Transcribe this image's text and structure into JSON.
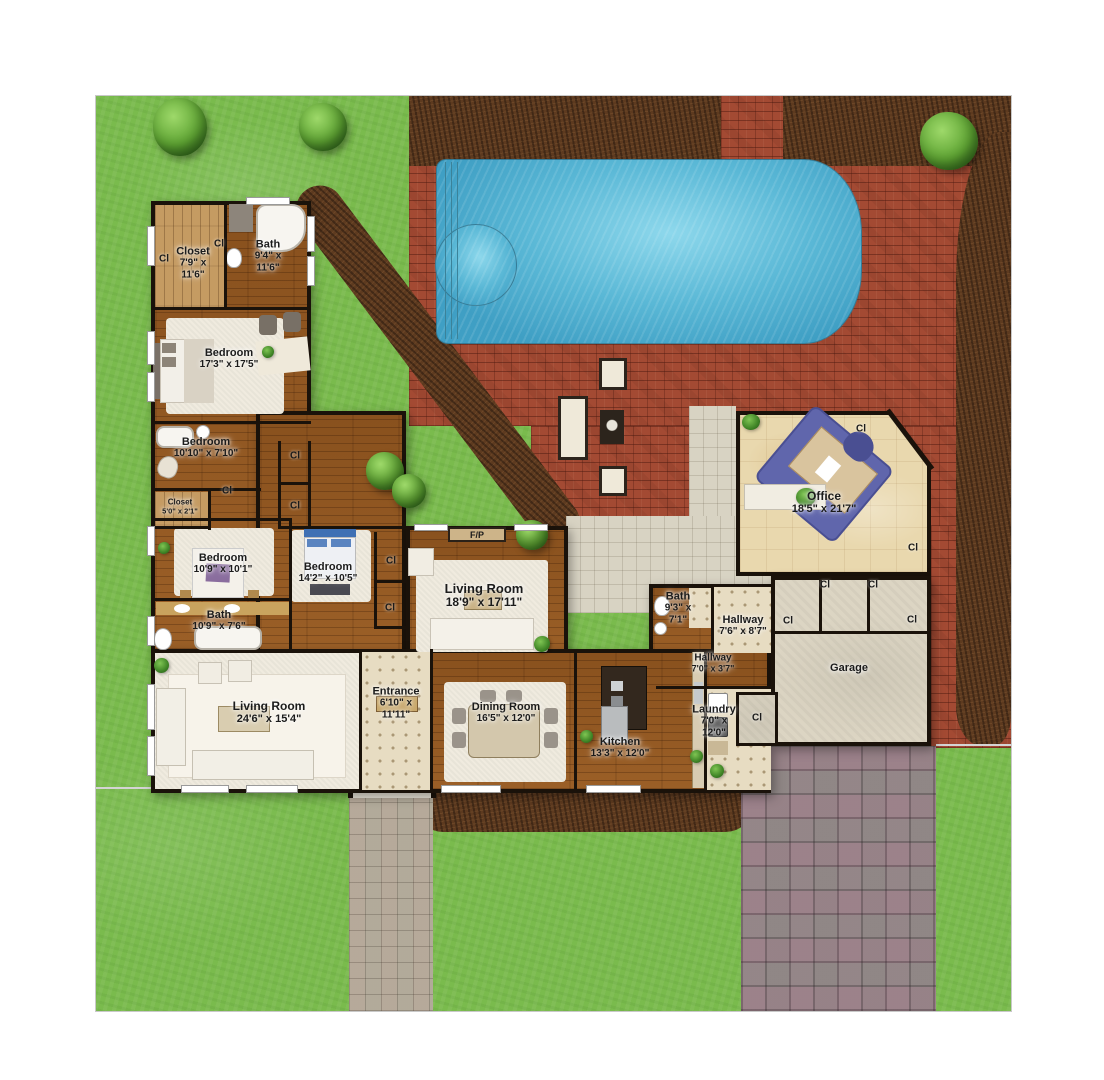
{
  "labels": {
    "closet": "Cl",
    "fireplace": "F/P"
  },
  "rooms": [
    {
      "id": "closet-master",
      "name": "Closet",
      "dims": "7'9\" x\n11'6\""
    },
    {
      "id": "bath-master",
      "name": "Bath",
      "dims": "9'4\" x\n11'6\""
    },
    {
      "id": "bedroom-master",
      "name": "Bedroom",
      "dims": "17'3\" x 17'5\""
    },
    {
      "id": "bedroom-2",
      "name": "Bedroom",
      "dims": "10'10\" x 7'10\""
    },
    {
      "id": "closet-2",
      "name": "Closet",
      "dims": "5'0\" x 2'1\""
    },
    {
      "id": "bedroom-3",
      "name": "Bedroom",
      "dims": "10'9\" x 10'1\""
    },
    {
      "id": "bath-2",
      "name": "Bath",
      "dims": "10'9\" x 7'6\""
    },
    {
      "id": "bedroom-4",
      "name": "Bedroom",
      "dims": "14'2\" x 10'5\""
    },
    {
      "id": "living-room-main",
      "name": "Living Room",
      "dims": "18'9\" x 17'11\""
    },
    {
      "id": "living-room-2",
      "name": "Living Room",
      "dims": "24'6\" x 15'4\""
    },
    {
      "id": "entrance",
      "name": "Entrance",
      "dims": "6'10\" x\n11'11\""
    },
    {
      "id": "dining-room",
      "name": "Dining Room",
      "dims": "16'5\" x 12'0\""
    },
    {
      "id": "kitchen",
      "name": "Kitchen",
      "dims": "13'3\" x 12'0\""
    },
    {
      "id": "bath-3",
      "name": "Bath",
      "dims": "9'3\" x\n7'1\""
    },
    {
      "id": "hallway-1",
      "name": "Hallway",
      "dims": "7'6\" x 8'7\""
    },
    {
      "id": "hallway-2",
      "name": "Hallway",
      "dims": "7'0\" x 3'7\""
    },
    {
      "id": "laundry",
      "name": "Laundry",
      "dims": "7'0\" x\n12'0\""
    },
    {
      "id": "office",
      "name": "Office",
      "dims": "18'5\" x 21'7\""
    },
    {
      "id": "garage",
      "name": "Garage",
      "dims": ""
    }
  ],
  "features": [
    "swimming-pool",
    "spa",
    "brick-patio",
    "paver-patio",
    "walkway",
    "driveway",
    "mulch-bed",
    "tree",
    "fire-pit",
    "outdoor-seating"
  ],
  "palette": {
    "grass": "#7abb4d",
    "brick": "#a34a33",
    "mortar": "#7c3526",
    "mulch": "#5d3a1f",
    "pool_water": "#5ab8d6",
    "wood_floor": "#935720",
    "closet_wood": "#c59b62",
    "carpet": "#f0ebdf",
    "tile": "#e7dcc2",
    "travertine": "#e9d8ae",
    "concrete": "#dcd5c3",
    "driveway": "#97898d",
    "patio_paver": "#d8d3c3",
    "wall": "#1a120a",
    "office_rug": "#6066ac",
    "bed_accent_blue": "#3f70b4"
  }
}
